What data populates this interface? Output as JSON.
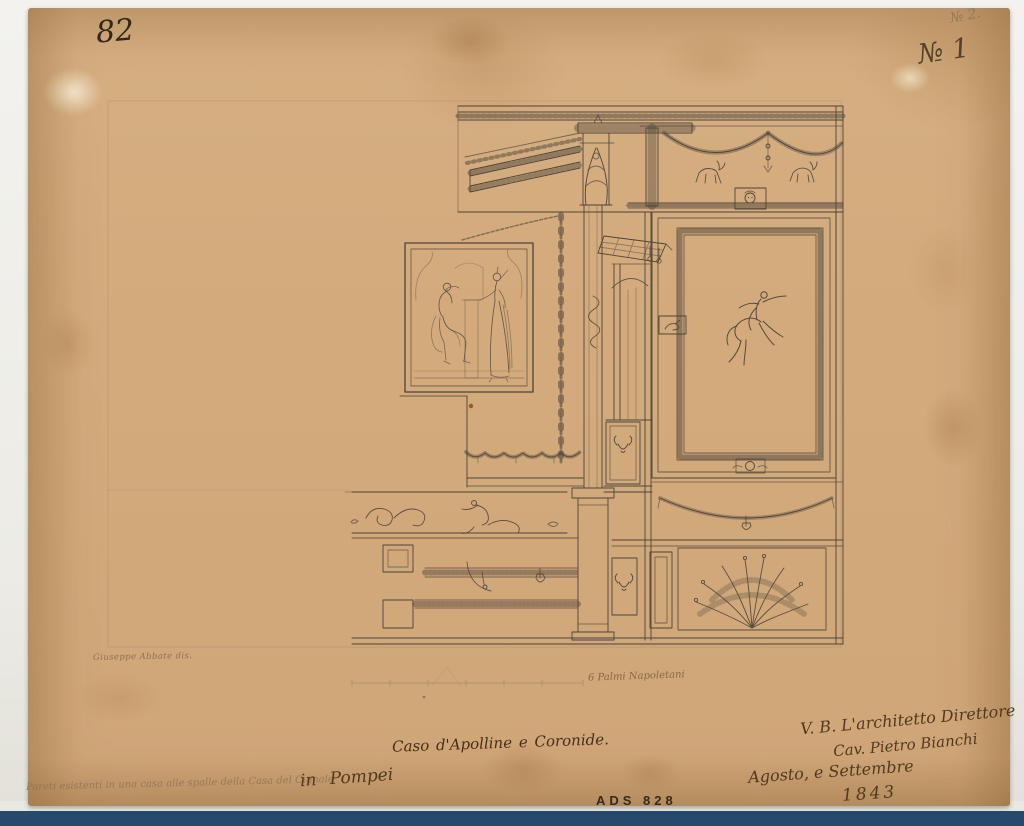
{
  "sheet": {
    "page_number": "82",
    "series_number_pencil": "№ 2.",
    "series_number_ink": "№ 1",
    "artist_signature": "Giuseppe Abbate dis.",
    "scale_label": "6 Palmi Napoletani",
    "caption": "Caso d'Apolline e Coronide.",
    "annotation_right": {
      "line1": "V. B. L'architetto Direttore",
      "line2": "Cav. Pietro Bianchi",
      "line3": "Agosto, e Settembre",
      "line4": "1843"
    },
    "annotation_bottom_left": {
      "pencil_text": "Pareti esistenti in una casa alle spalle della Casa del Cignale",
      "ink_text": "in Pompei"
    },
    "catalog_number": "ADS 828"
  },
  "colors": {
    "paper": "#d3ab7d",
    "ink_line": "#4d453c",
    "pencil": "#9b8660",
    "handwriting_ink": "#4f3a20",
    "handwriting_pencil": "#8e7653",
    "stamp": "#352a1c",
    "backing_blue": "#27496b"
  }
}
